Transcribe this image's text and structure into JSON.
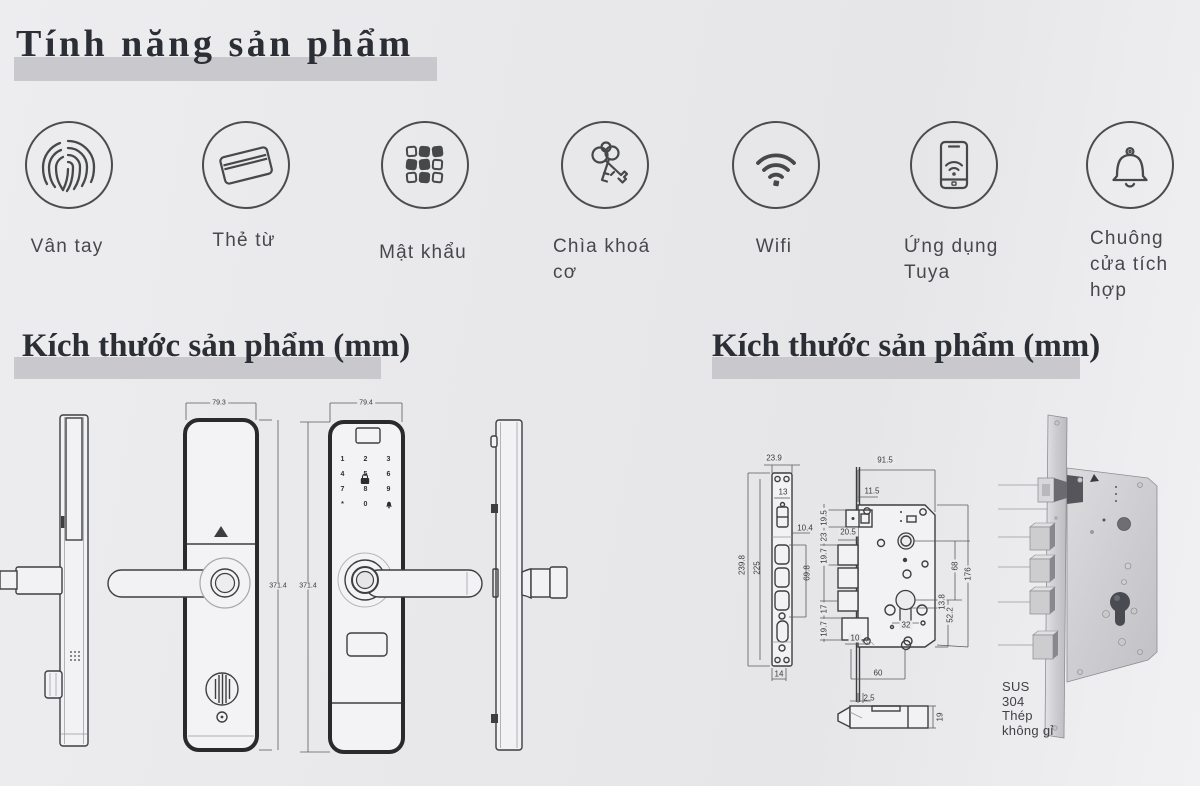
{
  "page": {
    "title": "Tính năng sản phẩm"
  },
  "sections": {
    "left_title": "Kích thước sản phẩm (mm)",
    "right_title": "Kích thước sản phẩm (mm)"
  },
  "features": [
    {
      "icon": "fingerprint-icon",
      "label": "Vân tay"
    },
    {
      "icon": "card-icon",
      "label": "Thẻ từ"
    },
    {
      "icon": "keypad-icon",
      "label": "Mật khẩu"
    },
    {
      "icon": "keys-icon",
      "label": "Chìa khoá cơ"
    },
    {
      "icon": "wifi-icon",
      "label": "Wifi"
    },
    {
      "icon": "phone-app-icon",
      "label": "Ứng dụng Tuya"
    },
    {
      "icon": "doorbell-icon",
      "label": "Chuông cửa tích hợp"
    }
  ],
  "lock_drawing": {
    "front_width": "79.3",
    "back_width": "79.4",
    "front_height": "371.4",
    "back_height": "371.4",
    "keypad_keys": [
      "1",
      "2",
      "3",
      "4",
      "5",
      "6",
      "7",
      "8",
      "9",
      "*",
      "0"
    ],
    "keypad_bell_icon": "bell-key-icon",
    "keypad_lock_icon": "lock-key-icon"
  },
  "mortise_drawing": {
    "faceplate_width": "23.9",
    "faceplate_hole_width": "13",
    "faceplate_height": "239.8",
    "faceplate_screw_span": "225",
    "bolt_offset": "10.4",
    "bolt_span": "69.8",
    "faceplate_bottom_width": "14",
    "body_width": "91.5",
    "latch_depth": "11.5",
    "seg_19_5": "19.5",
    "seg_23": "23",
    "seg_19_7_a": "19.7",
    "bolt_width": "20.5",
    "seg_17": "17",
    "seg_19_7_b": "19.7",
    "seg_10": "10",
    "spindle_to_cylinder": "68",
    "body_height": "176",
    "cyl_offset": "13.8",
    "cyl_bottom": "52.2",
    "cylinder_screw_span": "32",
    "bottom_span": "60",
    "latch_lip": "2.5",
    "latch_profile_height": "19",
    "material_lines": [
      "SUS",
      "304",
      "Thép",
      "không gỉ"
    ]
  }
}
